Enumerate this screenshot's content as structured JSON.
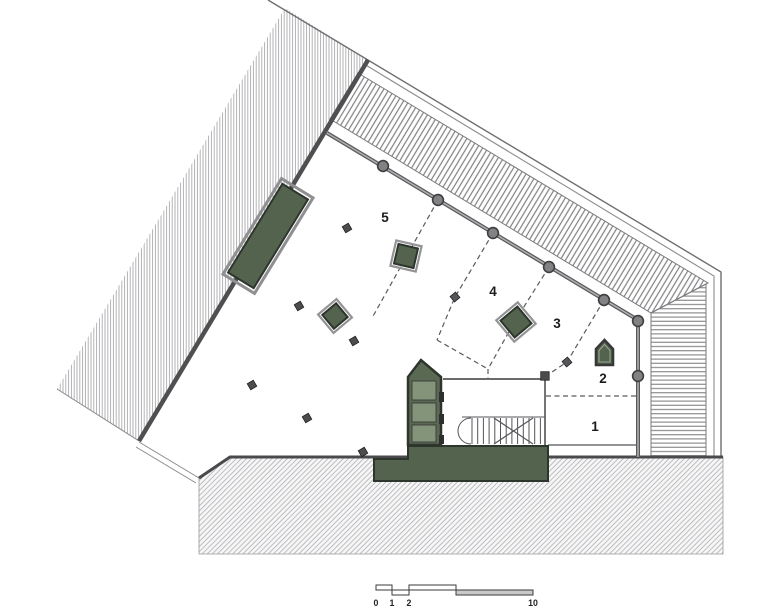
{
  "plan": {
    "zone_labels": {
      "z1": "1",
      "z2": "2",
      "z3": "3",
      "z4": "4",
      "z5": "5"
    },
    "scale_bar": {
      "labels": [
        "0",
        "1",
        "2",
        "5",
        "10"
      ]
    },
    "colors": {
      "accent_green": "#53634e",
      "green_core": "#5a6a52",
      "green_panel": "#83947b",
      "wall_dark": "#4a4a4c",
      "column_gray": "#828285",
      "hatch_line": "#ababae",
      "ground_hatch_line": "#b9b9bc",
      "scale_fill": "#c9c9ca"
    }
  }
}
